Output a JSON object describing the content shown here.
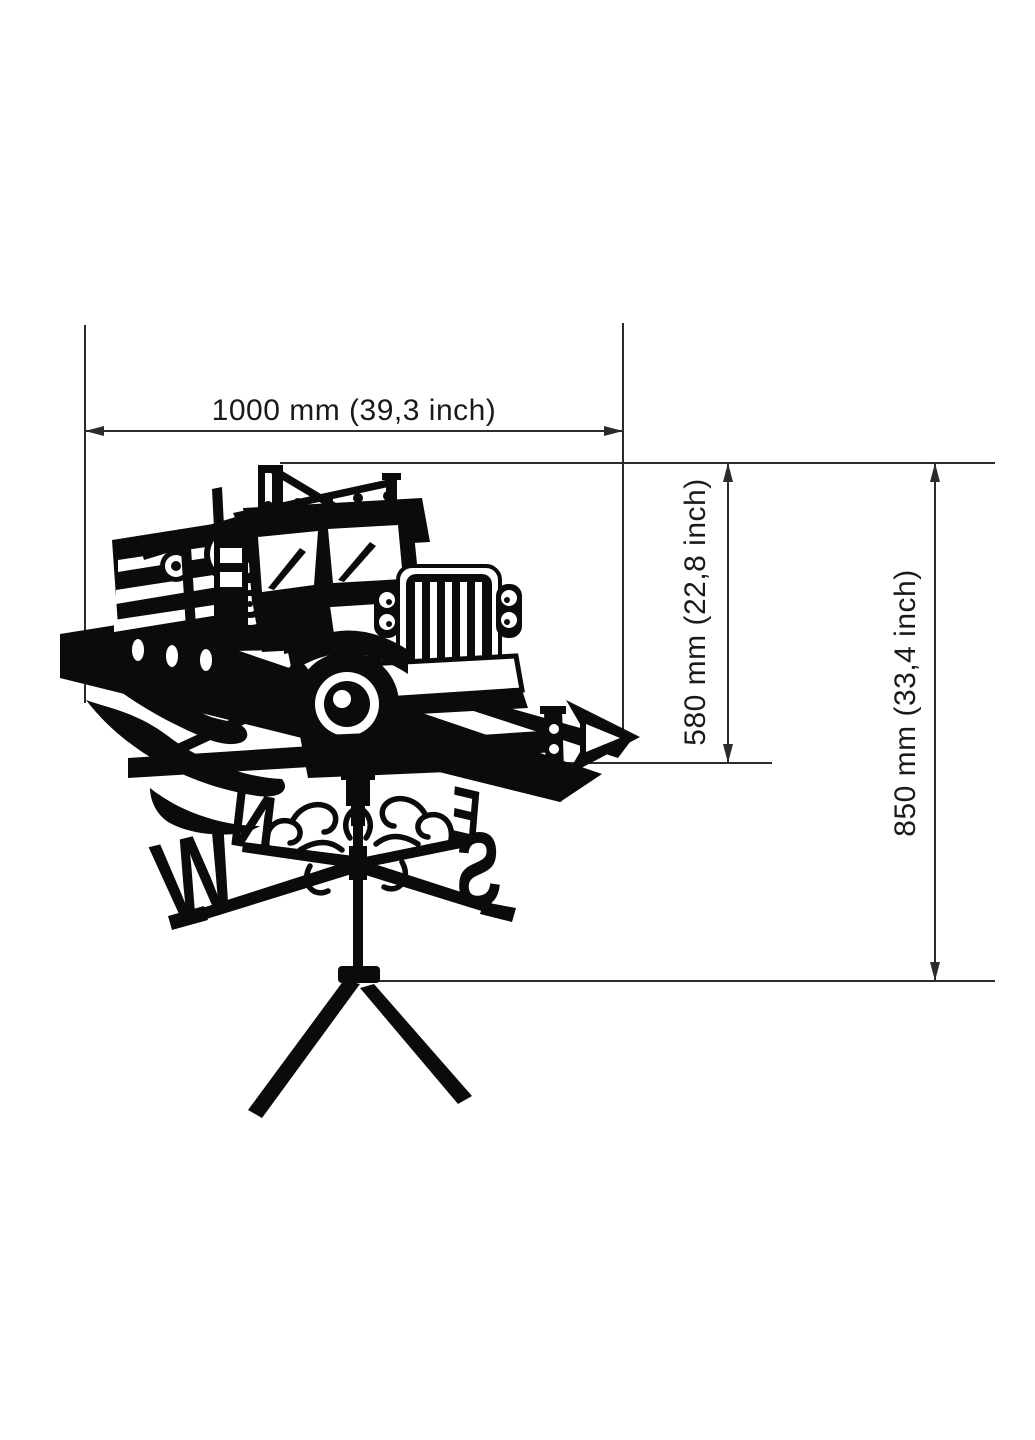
{
  "page": {
    "background_color": "#ffffff",
    "ink_color": "#0b0b0b",
    "dimension_line_color": "#2b2b2b"
  },
  "dimensions": {
    "width_label": "1000 mm (39,3 inch)",
    "vane_height_label": "580 mm (22,8 inch)",
    "overall_height_label": "850 mm (33,4 inch)"
  },
  "figure": {
    "subject": "logging-truck-weathervane-silhouette",
    "compass": {
      "north": "N",
      "east": "E",
      "south": "S",
      "west": "W"
    }
  }
}
